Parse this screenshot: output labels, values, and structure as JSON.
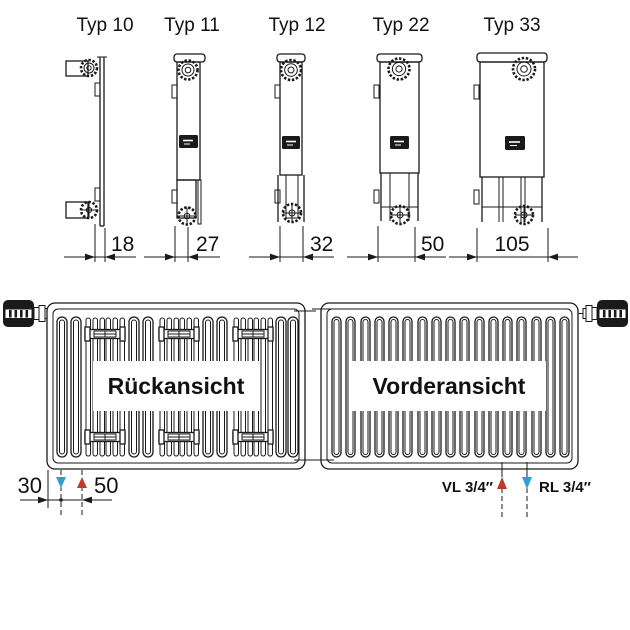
{
  "types": [
    {
      "label": "Typ 10",
      "depth": "18"
    },
    {
      "label": "Typ 11",
      "depth": "27"
    },
    {
      "label": "Typ 12",
      "depth": "32"
    },
    {
      "label": "Typ 22",
      "depth": "50"
    },
    {
      "label": "Typ 33",
      "depth": "105"
    }
  ],
  "views": {
    "rear": "Rückansicht",
    "front": "Vorderansicht"
  },
  "dims": {
    "wall_offset": "30",
    "connection_spacing": "50"
  },
  "connections": {
    "supply": "VL 3/4″",
    "return": "RL 3/4″"
  },
  "colors": {
    "line": "#1a1a1a",
    "supply_red": "#c0392b",
    "return_blue": "#2d9fd6"
  }
}
